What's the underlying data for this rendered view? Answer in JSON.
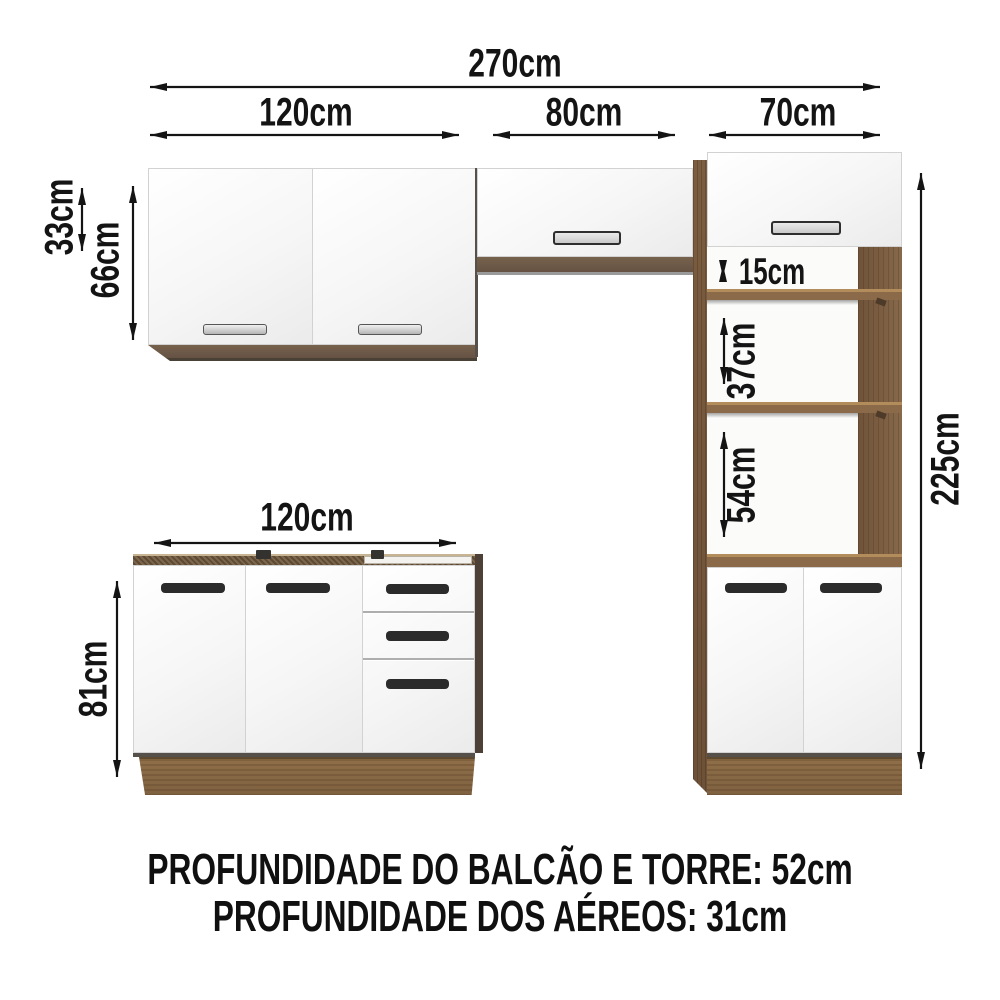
{
  "dimensions": {
    "total_width": "270cm",
    "upper_left_width": "120cm",
    "upper_mid_width": "80cm",
    "tower_width": "70cm",
    "upper_mid_height": "33cm",
    "upper_left_height": "66cm",
    "tower_niche_gap_top": "15cm",
    "tower_niche_gap_middle": "37cm",
    "tower_niche_gap_bottom": "54cm",
    "tower_height": "225cm",
    "base_width": "120cm",
    "base_height": "81cm"
  },
  "footer": {
    "line1": "PROFUNDIDADE DO BALCÃO E TORRE: 52cm",
    "line2": "PROFUNDIDADE DOS AÉREOS: 31cm"
  },
  "colors": {
    "wood_dark": "#5d4934",
    "wood_medium": "#7b5d40",
    "wood_light": "#8f6f49",
    "handle_dark": "#2b2b2b",
    "arrow_black": "#141414"
  }
}
